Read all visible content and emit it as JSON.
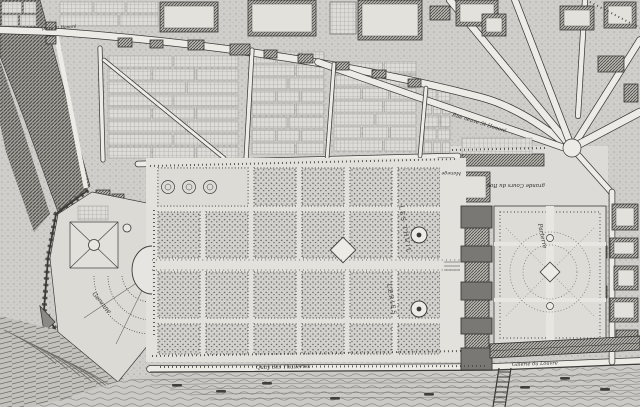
{
  "image": {
    "type": "engraved-map",
    "subject": "Plan of the Tuileries quarter of Paris: bastioned city wall, Tuileries garden and palace, parterre garden, Grande Galerie, and the Seine",
    "style": "17th-century copperplate engraving, grayscale stipple and hatch"
  },
  "palette": {
    "paper": "#d6d5d1",
    "ink": "#3a3a38",
    "street": "#edebe6",
    "water": "#cbcac7"
  },
  "labels": {
    "porte_st_honore": "porte St Honoré",
    "rue_neuve_st_honore": "Rue neuve St Honoré",
    "les_thuil": "LES THUIL",
    "leries": "LERIES",
    "garenne": "Garenne",
    "grande_cours_du_roy": "grande Cours du Roy",
    "manege": "Manege",
    "parterre": "Parterre",
    "quay_des_thuileries": "Quay des Thuileries",
    "galerie_du_louvre": "Galerie du Louvre"
  },
  "regions": {
    "garden": "Tuileries garden bosquet grid with round basins",
    "palace": "Tuileries palace (row of pavilions)",
    "parterre_garden": "Parterre garden east of the palace",
    "river": "Seine river with small boats",
    "gallery": "Grande Galerie along the river",
    "rampart": "City wall, moat and bastion",
    "west_garden": "Fortified west garden with knot parterre and fan parterre",
    "faubourg": "Streets, houses and market-garden plots north of the garden"
  }
}
